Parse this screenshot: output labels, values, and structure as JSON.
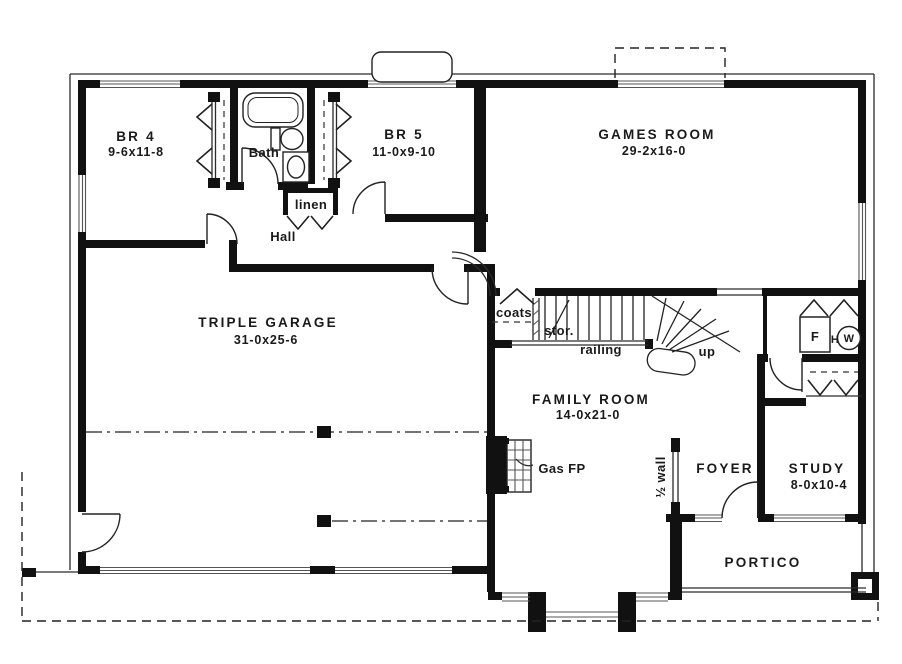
{
  "plan": {
    "title": "Floor plan",
    "rooms": {
      "br4": {
        "name": "BR 4",
        "dims": "9-6x11-8"
      },
      "bath": {
        "name": "Bath"
      },
      "br5": {
        "name": "BR 5",
        "dims": "11-0x9-10"
      },
      "games_room": {
        "name": "GAMES ROOM",
        "dims": "29-2x16-0"
      },
      "hall": {
        "name": "Hall"
      },
      "triple_garage": {
        "name": "TRIPLE GARAGE",
        "dims": "31-0x25-6"
      },
      "family_room": {
        "name": "FAMILY ROOM",
        "dims": "14-0x21-0"
      },
      "foyer": {
        "name": "FOYER"
      },
      "study": {
        "name": "STUDY",
        "dims": "8-0x10-4"
      },
      "portico": {
        "name": "PORTICO"
      }
    },
    "labels": {
      "linen": "linen",
      "coats": "coats",
      "storage": "stor.",
      "railing": "railing",
      "up": "up",
      "gas_fireplace": "Gas FP",
      "half_wall": "½ wall",
      "furnace": "F",
      "hot_water_h": "H",
      "hot_water_w": "W"
    },
    "colors": {
      "wall": "#111111",
      "line": "#2a2a2a",
      "background": "#ffffff"
    }
  }
}
